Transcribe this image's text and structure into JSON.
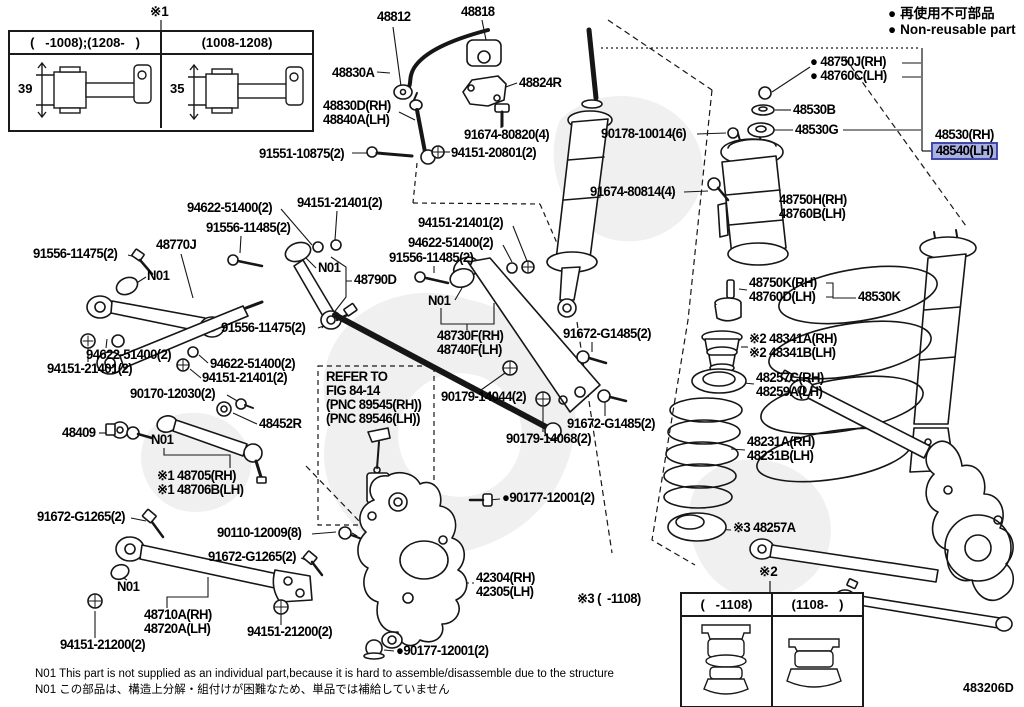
{
  "legend": {
    "bullet": "●",
    "item1": "再使用不可部品",
    "item2": "Non-reusable part"
  },
  "inset_top": {
    "marker": "※1",
    "col_left": "(   -1008);(1208-   )",
    "col_right": "(1008-1208)",
    "dim_left": "39",
    "dim_right": "35"
  },
  "inset_bottom": {
    "marker": "※2",
    "col_left": "(   -1108)",
    "col_right": "(1108-   )"
  },
  "footer": {
    "line1": "N01  This part is not supplied as an individual part,because it is hard to assemble/disassemble due to the structure",
    "line2": "N01 この部品は、構造上分解・組付けが困難なため、単品では補給していません"
  },
  "doc_code": "483206D",
  "highlight_color": "#a9b0e2",
  "labels": [
    {
      "lines": [
        "48812"
      ],
      "x": 377,
      "y": 10
    },
    {
      "lines": [
        "48818"
      ],
      "x": 461,
      "y": 5
    },
    {
      "lines": [
        "48830A"
      ],
      "x": 332,
      "y": 66
    },
    {
      "lines": [
        "48824R"
      ],
      "x": 519,
      "y": 76
    },
    {
      "lines": [
        "48830D(RH)",
        "48840A(LH)"
      ],
      "x": 323,
      "y": 99
    },
    {
      "lines": [
        "91674-80820(4)"
      ],
      "x": 464,
      "y": 128
    },
    {
      "lines": [
        "91551-10875(2)"
      ],
      "x": 259,
      "y": 147
    },
    {
      "lines": [
        "94151-20801(2)"
      ],
      "x": 451,
      "y": 146
    },
    {
      "lines": [
        "90178-10014(6)"
      ],
      "x": 601,
      "y": 127
    },
    {
      "lines": [
        "91674-80814(4)"
      ],
      "x": 590,
      "y": 185
    },
    {
      "lines": [
        "● 48750J(RH)",
        "● 48760C(LH)"
      ],
      "x": 810,
      "y": 55
    },
    {
      "lines": [
        "48530B"
      ],
      "x": 793,
      "y": 103
    },
    {
      "lines": [
        "48530G"
      ],
      "x": 795,
      "y": 123
    },
    {
      "lines": [
        "48530(RH)"
      ],
      "x": 935,
      "y": 128
    },
    {
      "lines": [
        "48540(LH)"
      ],
      "x": 935,
      "y": 144,
      "hl": true
    },
    {
      "lines": [
        "48750H(RH)",
        "48760B(LH)"
      ],
      "x": 779,
      "y": 193
    },
    {
      "lines": [
        "48750K(RH)",
        "48760D(LH)"
      ],
      "x": 749,
      "y": 276
    },
    {
      "lines": [
        "48530K"
      ],
      "x": 858,
      "y": 290
    },
    {
      "lines": [
        "※2 48341A(RH)",
        "※2 48341B(LH)"
      ],
      "x": 749,
      "y": 332
    },
    {
      "lines": [
        "48257C(RH)",
        "48259A(LH)"
      ],
      "x": 756,
      "y": 371
    },
    {
      "lines": [
        "48231A(RH)",
        "48231B(LH)"
      ],
      "x": 747,
      "y": 435
    },
    {
      "lines": [
        "※3 48257A"
      ],
      "x": 733,
      "y": 521
    },
    {
      "lines": [
        "48770J"
      ],
      "x": 156,
      "y": 238
    },
    {
      "lines": [
        "91556-11475(2)"
      ],
      "x": 33,
      "y": 247
    },
    {
      "lines": [
        "N01"
      ],
      "kind": "note",
      "x": 147,
      "y": 269
    },
    {
      "lines": [
        "94622-51400(2)"
      ],
      "x": 187,
      "y": 201
    },
    {
      "lines": [
        "91556-11485(2)"
      ],
      "x": 206,
      "y": 221
    },
    {
      "lines": [
        "94151-21401(2)"
      ],
      "x": 297,
      "y": 196
    },
    {
      "lines": [
        "N01"
      ],
      "kind": "note",
      "x": 318,
      "y": 261
    },
    {
      "lines": [
        "48790D"
      ],
      "x": 354,
      "y": 273
    },
    {
      "lines": [
        "91556-11475(2)"
      ],
      "x": 221,
      "y": 321
    },
    {
      "lines": [
        "94622-51400(2)"
      ],
      "x": 86,
      "y": 348
    },
    {
      "lines": [
        "94151-21401(2)"
      ],
      "x": 47,
      "y": 362
    },
    {
      "lines": [
        "94622-51400(2)"
      ],
      "x": 210,
      "y": 357
    },
    {
      "lines": [
        "94151-21401(2)"
      ],
      "x": 202,
      "y": 371
    },
    {
      "lines": [
        "94151-21401(2)"
      ],
      "x": 418,
      "y": 216
    },
    {
      "lines": [
        "94622-51400(2)"
      ],
      "x": 408,
      "y": 236
    },
    {
      "lines": [
        "91556-11485(2)"
      ],
      "x": 389,
      "y": 251
    },
    {
      "lines": [
        "N01"
      ],
      "kind": "note",
      "x": 428,
      "y": 294
    },
    {
      "lines": [
        "48730F(RH)",
        "48740F(LH)"
      ],
      "x": 437,
      "y": 329
    },
    {
      "lines": [
        "91672-G1485(2)"
      ],
      "x": 563,
      "y": 327
    },
    {
      "lines": [
        "90179-14044(2)"
      ],
      "x": 441,
      "y": 390
    },
    {
      "lines": [
        "91672-G1485(2)"
      ],
      "x": 567,
      "y": 417
    },
    {
      "lines": [
        "90179-14068(2)"
      ],
      "x": 506,
      "y": 432
    },
    {
      "lines": [
        "90170-12030(2)"
      ],
      "x": 130,
      "y": 387
    },
    {
      "lines": [
        "48452R"
      ],
      "x": 259,
      "y": 417
    },
    {
      "lines": [
        "48409"
      ],
      "x": 62,
      "y": 426
    },
    {
      "lines": [
        "N01"
      ],
      "kind": "note",
      "x": 151,
      "y": 433
    },
    {
      "lines": [
        "※1 48705(RH)",
        "※1 48706B(LH)"
      ],
      "x": 157,
      "y": 469
    },
    {
      "lines": [
        "91672-G1265(2)"
      ],
      "x": 37,
      "y": 510
    },
    {
      "lines": [
        "REFER TO",
        "FIG 84-14",
        "(PNC 89545(RH))",
        "(PNC 89546(LH))"
      ],
      "kind": "note",
      "x": 326,
      "y": 370
    },
    {
      "lines": [
        "90110-12009(8)"
      ],
      "x": 217,
      "y": 526
    },
    {
      "lines": [
        "91672-G1265(2)"
      ],
      "x": 208,
      "y": 550
    },
    {
      "lines": [
        "N01"
      ],
      "kind": "note",
      "x": 117,
      "y": 580
    },
    {
      "lines": [
        "48710A(RH)",
        "48720A(LH)"
      ],
      "x": 144,
      "y": 608
    },
    {
      "lines": [
        "94151-21200(2)"
      ],
      "x": 60,
      "y": 638
    },
    {
      "lines": [
        "94151-21200(2)"
      ],
      "x": 247,
      "y": 625
    },
    {
      "lines": [
        "42304(RH)",
        "42305(LH)"
      ],
      "x": 476,
      "y": 571
    },
    {
      "lines": [
        "●90177-12001(2)"
      ],
      "x": 502,
      "y": 491
    },
    {
      "lines": [
        "●90177-12001(2)"
      ],
      "x": 396,
      "y": 644
    },
    {
      "lines": [
        "※3 (  -1108)"
      ],
      "kind": "note",
      "x": 577,
      "y": 592
    }
  ]
}
